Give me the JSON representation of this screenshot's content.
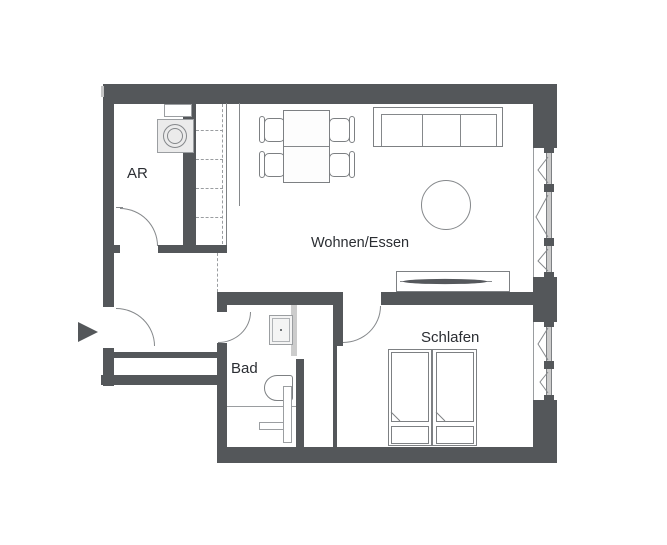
{
  "floorplan": {
    "title": "Apartment floor plan",
    "rooms": [
      {
        "id": "ar",
        "label": "AR"
      },
      {
        "id": "wohnen_essen",
        "label": "Wohnen/Essen"
      },
      {
        "id": "bad",
        "label": "Bad"
      },
      {
        "id": "schlafen",
        "label": "Schlafen"
      }
    ],
    "symbols": [
      "entry-arrow",
      "entry-door-arc",
      "ar-door-arc",
      "bad-door-arc",
      "schlafen-door-arc",
      "sliding-door-panel",
      "washing-machine",
      "kitchen-counter",
      "dining-table",
      "chairs",
      "sofa",
      "rug-circle",
      "tv-sideboard",
      "sink",
      "toilet",
      "shower-fixture",
      "twin-beds",
      "windows-with-casement-symbols"
    ],
    "colors": {
      "wall": "#54575a",
      "furniture_line": "#7d8083",
      "thin_line": "#85888b",
      "sliding_panel": "#cccccc",
      "appliance_fill": "#ebebeb",
      "text": "#2b2e33",
      "background": "#ffffff"
    }
  }
}
